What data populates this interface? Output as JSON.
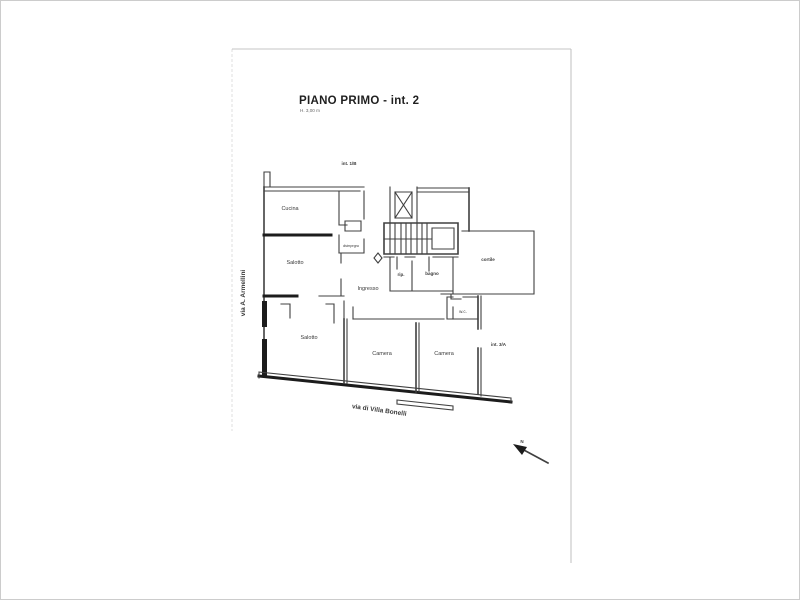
{
  "canvas": {
    "bg": "#ffffff",
    "border": "#cccccc",
    "frame": "#b8b8b8",
    "ink": "#404040",
    "ink_heavy": "#1c1c1c",
    "text": "#3a3a3a",
    "title_color": "#1f1f1f",
    "subtitle_color": "#666666"
  },
  "title": {
    "main": "PIANO PRIMO - int. 2",
    "subtitle": "H. 3,00 m"
  },
  "units": {
    "top_left_door": "int. 1/B",
    "right_door": "int. 3/A"
  },
  "streets": {
    "west": "via A. Armellini",
    "south": "via di Villa Bonelli"
  },
  "rooms": {
    "cucina": "Cucina",
    "disimpegno": "disimpegno",
    "salotto_mid": "Salotto",
    "ingresso": "Ingresso",
    "ripostiglio": "rip.",
    "bagno": "bagno",
    "cortile": "cortile",
    "wc": "w.c.",
    "salotto_sud": "Salotto",
    "camera_1": "Camera",
    "camera_2": "Camera"
  },
  "compass": {
    "label": "N"
  }
}
